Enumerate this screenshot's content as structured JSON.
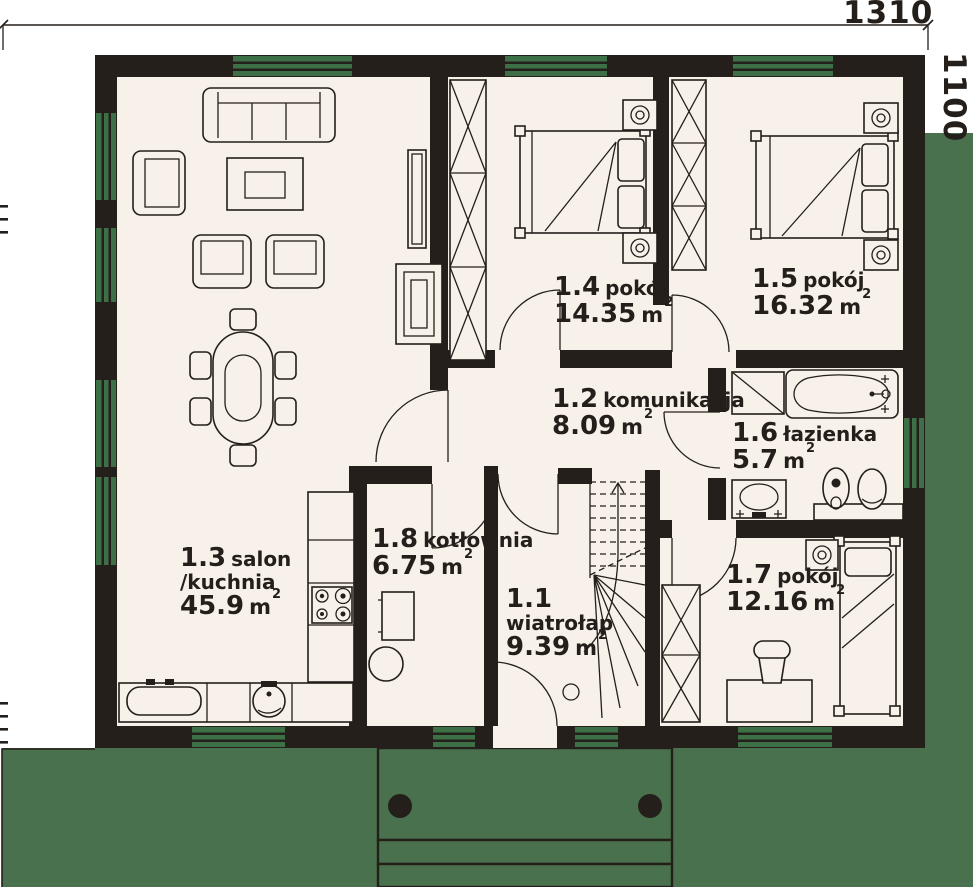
{
  "dimensions": {
    "top": "1310",
    "right": "1100"
  },
  "rooms": [
    {
      "number": "1.1",
      "name": "wiatrołap",
      "area": "9.39",
      "unit": "m",
      "sup": "2"
    },
    {
      "number": "1.2",
      "name": "komunikacja",
      "area": "8.09",
      "unit": "m",
      "sup": "2"
    },
    {
      "number": "1.3",
      "name": "salon",
      "name2": "/kuchnia",
      "area": "45.9",
      "unit": "m",
      "sup": "2"
    },
    {
      "number": "1.4",
      "name": "pokój",
      "area": "14.35",
      "unit": "m",
      "sup": "2"
    },
    {
      "number": "1.5",
      "name": "pokój",
      "area": "16.32",
      "unit": "m",
      "sup": "2"
    },
    {
      "number": "1.6",
      "name": "łazienka",
      "area": "5.7",
      "unit": "m",
      "sup": "2"
    },
    {
      "number": "1.7",
      "name": "pokój",
      "area": "12.16",
      "unit": "m",
      "sup": "2"
    },
    {
      "number": "1.8",
      "name": "kotłownia",
      "area": "6.75",
      "unit": "m",
      "sup": "2"
    }
  ],
  "colors": {
    "wall": "#241f1a",
    "floor": "#f8f1ea",
    "grass": "#4a714d",
    "window": "#3e7048",
    "background": "#ffffff"
  }
}
